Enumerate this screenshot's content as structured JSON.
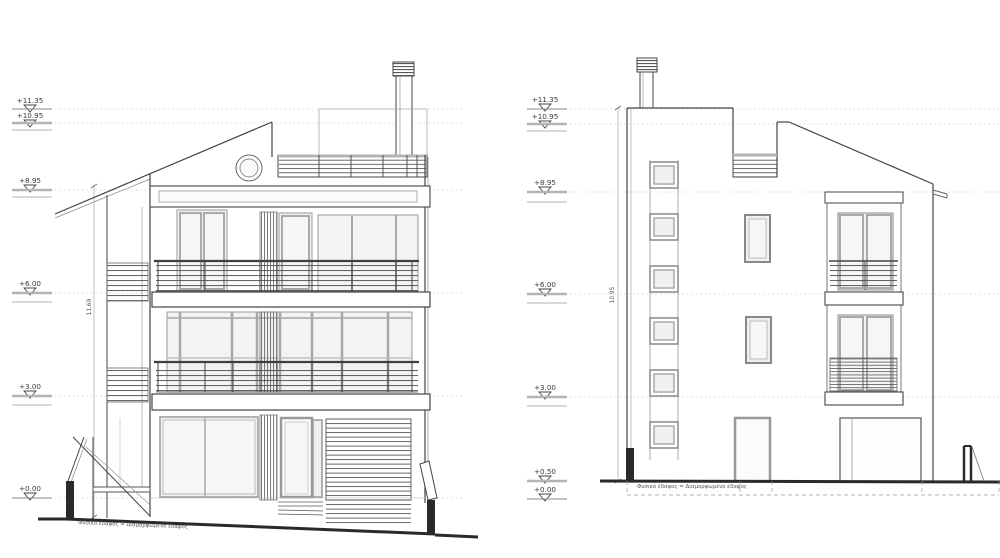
{
  "page": {
    "background": "#ffffff",
    "line_color": "#3f3f3f"
  },
  "front_elevation": {
    "label": "front-elevation",
    "levels": [
      "+11.35",
      "+10.95",
      "+8.95",
      "+6.00",
      "+3.00",
      "+0.00"
    ],
    "height_dim": "11.69",
    "ground_note": "Φυσικό έδαφος = Διαμορφωμένο έδαφος"
  },
  "side_elevation": {
    "label": "side-elevation",
    "levels": [
      "+11.35",
      "+10.95",
      "+8.95",
      "+6.00",
      "+3.00",
      "+0.50",
      "+0.00"
    ],
    "height_dim": "10.95",
    "ground_note": "Φυσικό έδαφος = Διαμορφωμένο έδαφος"
  }
}
